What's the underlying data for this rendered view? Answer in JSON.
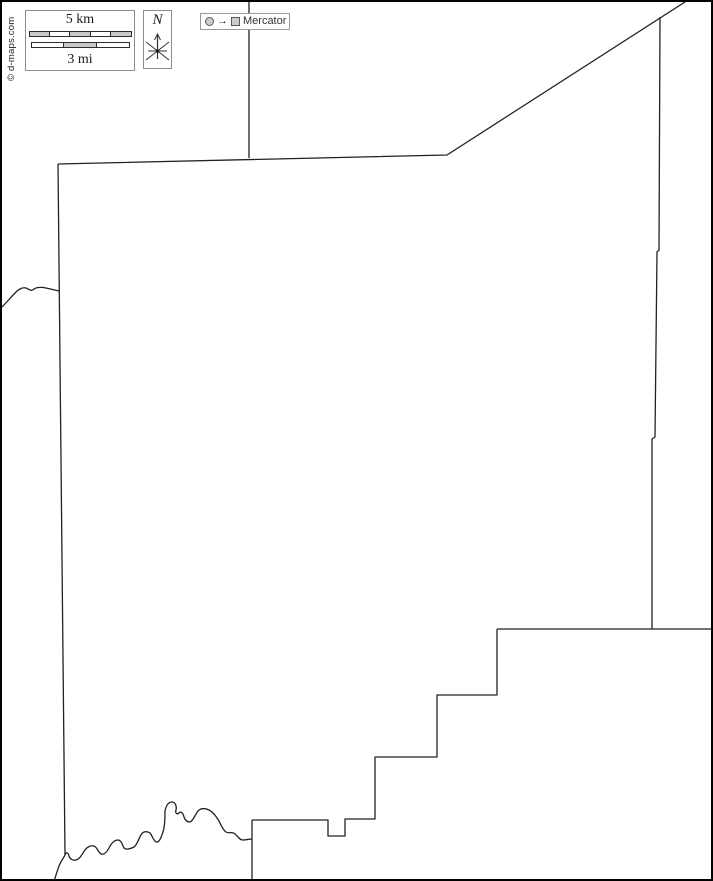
{
  "branding": {
    "copyright": "© d-maps.com"
  },
  "scale_bar": {
    "km_label": "5 km",
    "mi_label": "3 mi",
    "km_segments": 5,
    "mi_segments": 3
  },
  "compass": {
    "north_label": "N"
  },
  "projection": {
    "label": "Mercator",
    "arrow_glyph": "→"
  },
  "colors": {
    "outline": "#222222",
    "box_border": "#8c8c8c",
    "bar_fill": "#c9c9c9",
    "bar_empty": "#ffffff",
    "background": "#ffffff",
    "frame": "#000000"
  },
  "map": {
    "region_paths": [
      {
        "name": "north-boundary-extension",
        "d": "M247,0 L247,156"
      },
      {
        "name": "county-north-boundary",
        "d": "M56,162 L445,153 L683,0"
      },
      {
        "name": "county-east-boundary",
        "d": "M658,15 L657,248 L655,250 L653,435 L650,437 L650,627"
      },
      {
        "name": "southeast-horizontal-extension",
        "d": "M495,627 L713,627"
      },
      {
        "name": "county-southeast-steps",
        "d": "M495,627 L495,693 L435,693 L435,755 L373,755 L373,817 L343,817 L343,834 L326,834 L326,818 L250,818"
      },
      {
        "name": "south-boundary-extension",
        "d": "M250,818 L250,881"
      },
      {
        "name": "county-west-boundary",
        "d": "M56,162 L63,853"
      },
      {
        "name": "west-river-tributary",
        "d": "M0,305 C5,300 9,295 14,290 C17,287 21,285 24,286 C27,287 29,290 32,287 C35,285 39,285 44,286 C48,287 53,288 57,289"
      },
      {
        "name": "south-river-boundary",
        "d": "M52,879 C55,871 56,864 60,858 C62,855 62,855 63,853 C64,850 66,850 67,854 C68,857 71,859 74,858 C78,857 80,852 83,848 C85,845 89,843 92,844 C95,845 96,850 99,852 C102,853 105,850 107,846 C109,842 112,838 116,838 C119,838 120,842 122,846 C124,848 128,847 132,845 C135,843 136,838 139,833 C141,829 145,829 148,831 C150,833 151,838 154,840 C157,841 159,836 161,830 C163,824 163,816 163,809 C164,804 166,800 170,800 C173,800 175,804 174,808 C173,811 175,813 177,811 C179,809 181,811 182,815 C183,818 185,820 188,820 C191,819 193,813 196,809 C199,806 203,806 207,808 C211,810 214,814 217,819 C219,823 221,828 224,830 C227,832 230,829 233,832 C236,834 237,838 241,838 C245,838 247,837 250,837"
      }
    ]
  }
}
